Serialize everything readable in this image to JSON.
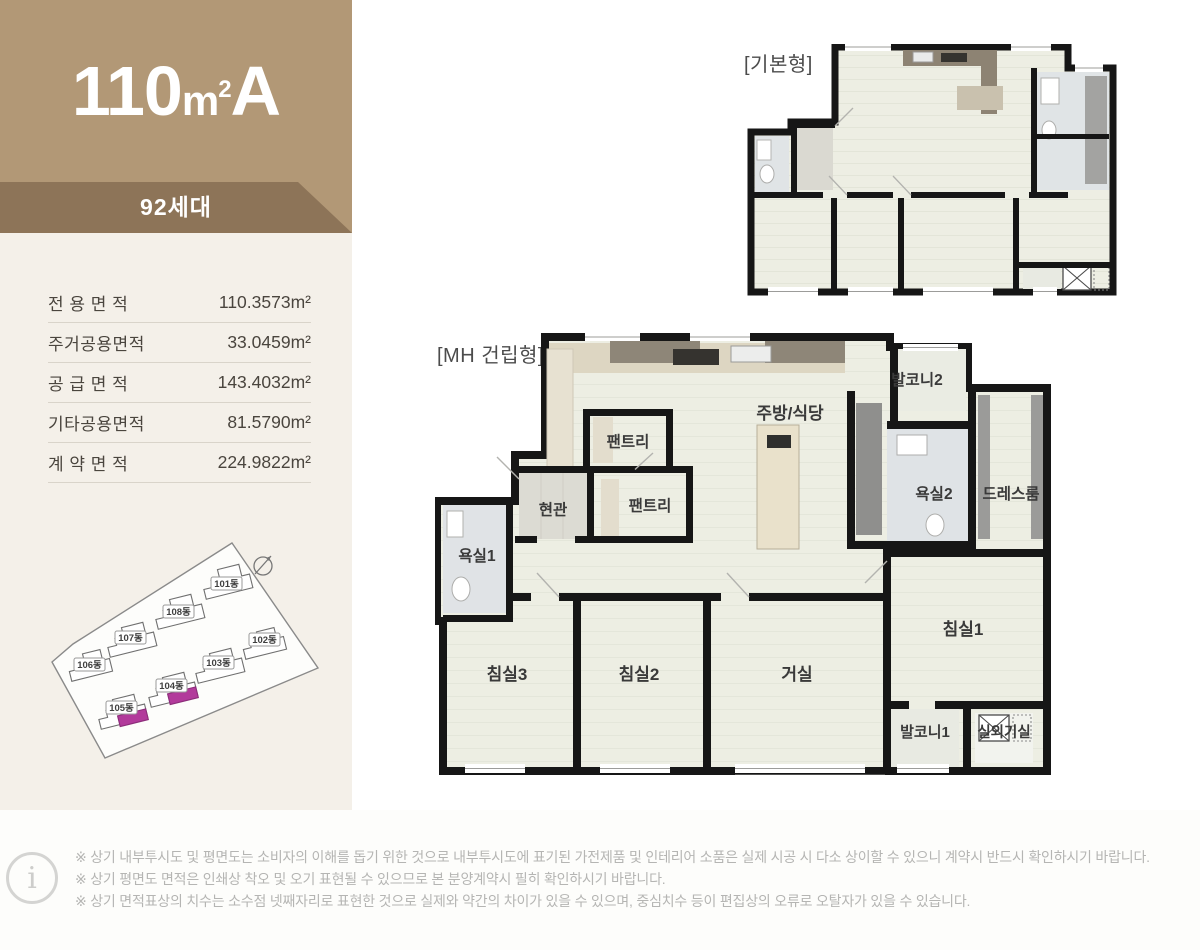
{
  "header": {
    "size": "110",
    "unit_m": "m",
    "unit_sup": "2",
    "type_letter": "A",
    "households": "92세대",
    "colors": {
      "band": "#b29876",
      "ribbon": "#8d7458",
      "panel": "#f4f0e9"
    }
  },
  "area_table": {
    "rows": [
      {
        "label": "전 용 면 적",
        "value": "110.3573m²"
      },
      {
        "label": "주거공용면적",
        "value": "33.0459m²"
      },
      {
        "label": "공 급 면 적",
        "value": "143.4032m²"
      },
      {
        "label": "기타공용면적",
        "value": "81.5790m²"
      },
      {
        "label": "계 약 면 적",
        "value": "224.9822m²"
      }
    ]
  },
  "sitemap": {
    "highlight_color": "#b23a9b",
    "compass_icon": "compass-icon",
    "buildings": [
      {
        "label": "101동",
        "highlighted": false
      },
      {
        "label": "102동",
        "highlighted": false
      },
      {
        "label": "103동",
        "highlighted": false
      },
      {
        "label": "104동",
        "highlighted": true
      },
      {
        "label": "105동",
        "highlighted": true
      },
      {
        "label": "106동",
        "highlighted": false
      },
      {
        "label": "107동",
        "highlighted": false
      },
      {
        "label": "108동",
        "highlighted": false
      }
    ]
  },
  "plans": {
    "basic": {
      "title": "[기본형]"
    },
    "mh": {
      "title": "[MH 건립형]",
      "rooms": {
        "kitchen_dining": "주방/식당",
        "balcony2": "발코니2",
        "bath2": "욕실2",
        "dressroom": "드레스룸",
        "pantry_upper": "팬트리",
        "pantry_lower": "팬트리",
        "entrance": "현관",
        "bath1": "욕실1",
        "bed3": "침실3",
        "bed2": "침실2",
        "living": "거실",
        "bed1": "침실1",
        "balcony1": "발코니1",
        "outdoor_unit": "실외기실"
      }
    }
  },
  "footer": {
    "info_icon": "i",
    "notes": [
      "※ 상기 내부투시도 및 평면도는 소비자의 이해를 돕기 위한 것으로 내부투시도에 표기된 가전제품 및 인테리어 소품은 실제 시공 시 다소 상이할 수 있으니 계약시 반드시 확인하시기 바랍니다.",
      "※ 상기 평면도 면적은 인쇄상 착오 및 오기 표현될 수 있으므로 본 분양계약시 필히 확인하시기 바랍니다.",
      "※ 상기 면적표상의 치수는 소수점 넷째자리로 표현한 것으로 실제와 약간의 차이가 있을 수 있으며, 중심치수 등이 편집상의 오류로 오탈자가 있을 수 있습니다."
    ]
  }
}
